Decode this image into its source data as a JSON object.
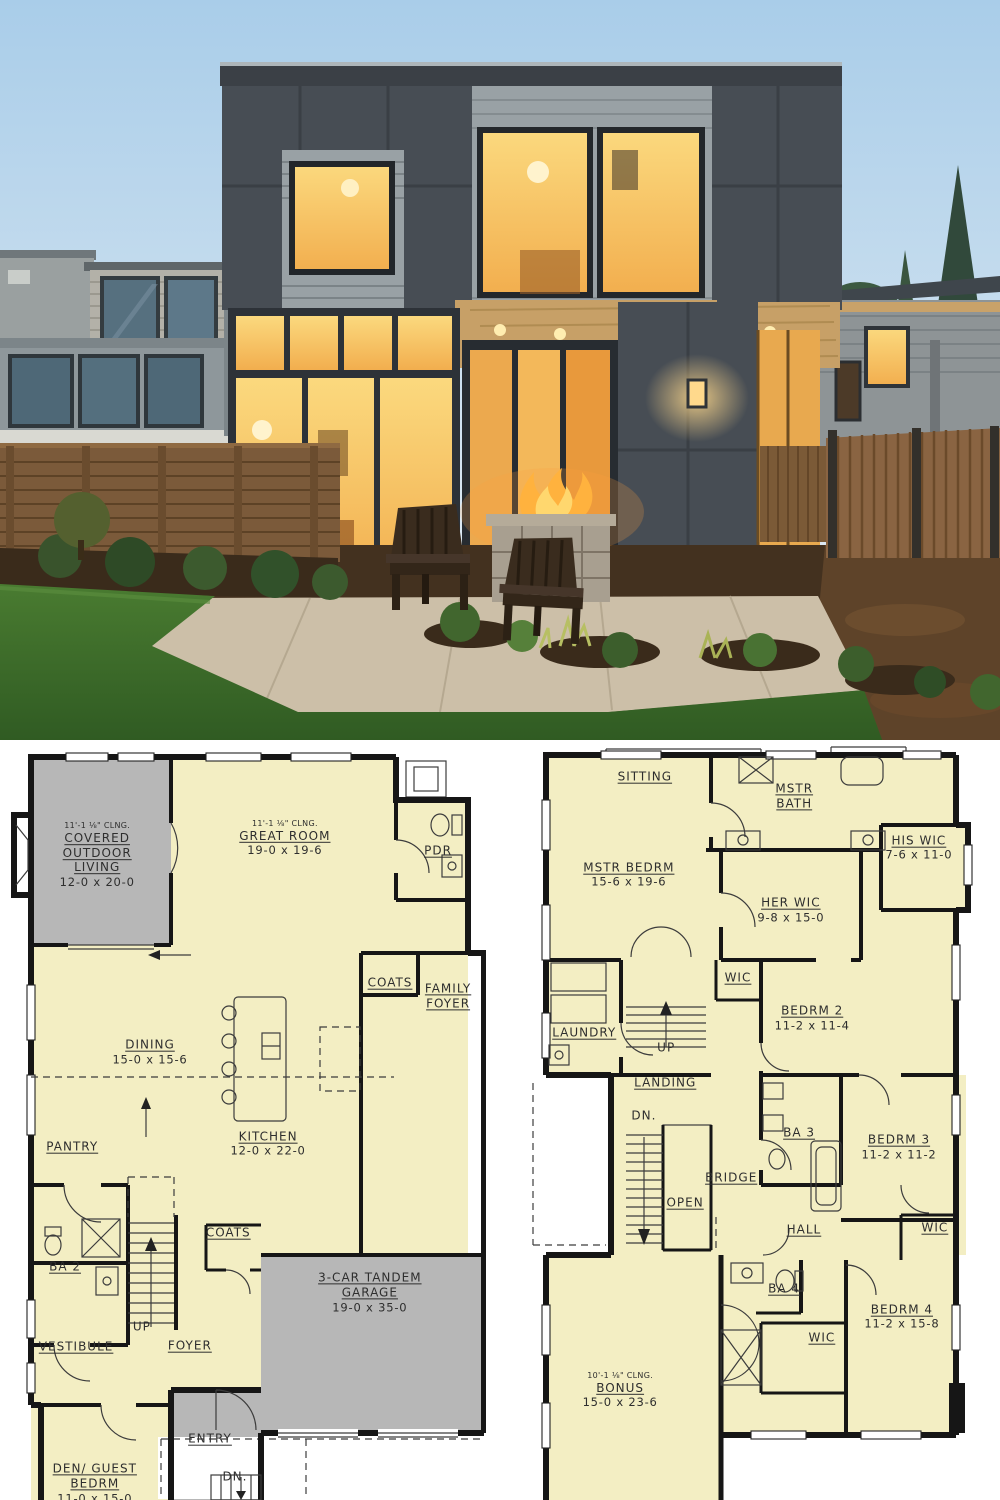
{
  "palette": {
    "sky_top": "#a9cde9",
    "sky_horizon": "#dde9f2",
    "siding_charcoal": "#474d54",
    "siding_gray": "#99a1a5",
    "window_glow": "#f2ae4e",
    "window_glow_light": "#fbd97e",
    "porch_wood": "#c7a067",
    "lawn": "#4a7c31",
    "lawn_dark": "#2f5a22",
    "fence_left": "#7b5a3a",
    "fence_right": "#8a6442",
    "mulch": "#5e4329",
    "patio": "#ccbfa8",
    "flame": "#ffb23e",
    "plan_room": "#f3eec3",
    "plan_gray": "#b7b7b7",
    "plan_wall": "#161616",
    "plan_line": "#3c3c3c",
    "plan_text": "#2e2e2e"
  },
  "floorplans": {
    "left": {
      "id": "main-floor",
      "rooms": [
        {
          "id": "covered-outdoor-living",
          "note": "11'-1 ⅛\" CLNG.",
          "name": "COVERED\nOUTDOOR\nLIVING",
          "dims": "12-0 x 20-0",
          "cx": 19.0,
          "cy": 14.6
        },
        {
          "id": "great-room",
          "note": "11'-1 ⅛\" CLNG.",
          "name": "GREAT ROOM",
          "dims": "19-0 x 19-6",
          "cx": 58.1,
          "cy": 12.3
        },
        {
          "id": "pdr",
          "name": "PDR",
          "cx": 90.0,
          "cy": 14.0
        },
        {
          "id": "coats-upper",
          "name": "COATS",
          "cx": 80.0,
          "cy": 31.5
        },
        {
          "id": "family-foyer",
          "name": "FAMILY\nFOYER",
          "cx": 92.1,
          "cy": 33.3
        },
        {
          "id": "dining",
          "name": "DINING",
          "dims": "15-0 x 15-6",
          "cx": 30.0,
          "cy": 40.7
        },
        {
          "id": "kitchen",
          "name": "KITCHEN",
          "dims": "12-0 x 22-0",
          "cx": 54.6,
          "cy": 52.8
        },
        {
          "id": "pantry",
          "name": "PANTRY",
          "cx": 13.8,
          "cy": 53.2
        },
        {
          "id": "ba-2",
          "name": "BA 2",
          "cx": 12.3,
          "cy": 69.1
        },
        {
          "id": "coats-lower",
          "name": "COATS",
          "cx": 46.3,
          "cy": 64.6
        },
        {
          "id": "up",
          "name": "UP",
          "u": false,
          "cx": 28.3,
          "cy": 77.1
        },
        {
          "id": "garage",
          "name": "3-CAR TANDEM\nGARAGE",
          "dims": "19-0 x 35-0",
          "cx": 75.8,
          "cy": 72.5
        },
        {
          "id": "vestibule",
          "name": "VESTIBULE",
          "cx": 14.6,
          "cy": 79.7
        },
        {
          "id": "foyer",
          "name": "FOYER",
          "cx": 38.3,
          "cy": 79.6
        },
        {
          "id": "entry",
          "name": "ENTRY",
          "cx": 42.5,
          "cy": 91.9
        },
        {
          "id": "dn",
          "name": "DN.",
          "u": false,
          "cx": 47.7,
          "cy": 97.0
        },
        {
          "id": "den-guest-bedrm",
          "name": "DEN/ GUEST\nBEDRM",
          "dims": "11-0 x 15-0",
          "cx": 18.5,
          "cy": 97.8
        }
      ]
    },
    "right": {
      "id": "upper-floor",
      "rooms": [
        {
          "id": "sitting",
          "name": "SITTING",
          "cx": 27.6,
          "cy": 4.2
        },
        {
          "id": "mstr-bath",
          "name": "MSTR\nBATH",
          "cx": 58.4,
          "cy": 6.8
        },
        {
          "id": "his-wic",
          "name": "HIS WIC",
          "dims": "7-6 x 11-0",
          "cx": 84.1,
          "cy": 13.6
        },
        {
          "id": "mstr-bedrm",
          "name": "MSTR BEDRM",
          "dims": "15-6 x 19-6",
          "cx": 24.3,
          "cy": 17.2
        },
        {
          "id": "her-wic",
          "name": "HER WIC",
          "dims": "9-8 x 15-0",
          "cx": 57.7,
          "cy": 21.9
        },
        {
          "id": "wic-bedrm2",
          "name": "WIC",
          "cx": 46.8,
          "cy": 30.8
        },
        {
          "id": "bedrm-2",
          "name": "BEDRM 2",
          "dims": "11-2 x 11-4",
          "cx": 62.1,
          "cy": 36.2
        },
        {
          "id": "laundry",
          "name": "LAUNDRY",
          "cx": 15.1,
          "cy": 38.2
        },
        {
          "id": "up",
          "name": "UP",
          "u": false,
          "cx": 32.0,
          "cy": 40.1
        },
        {
          "id": "landing",
          "name": "LANDING",
          "cx": 31.8,
          "cy": 44.8
        },
        {
          "id": "dn",
          "name": "DN.",
          "u": false,
          "cx": 27.4,
          "cy": 49.2
        },
        {
          "id": "open",
          "name": "OPEN",
          "cx": 35.9,
          "cy": 60.6
        },
        {
          "id": "bridge",
          "name": "BRIDGE",
          "cx": 45.4,
          "cy": 57.4
        },
        {
          "id": "ba-3",
          "name": "BA 3",
          "cx": 59.4,
          "cy": 51.4
        },
        {
          "id": "bedrm-3",
          "name": "BEDRM 3",
          "dims": "11-2 x 11-2",
          "cx": 80.0,
          "cy": 53.3
        },
        {
          "id": "hall",
          "name": "HALL",
          "cx": 60.4,
          "cy": 64.3
        },
        {
          "id": "wic-bedrm3",
          "name": "WIC",
          "cx": 87.4,
          "cy": 64.0
        },
        {
          "id": "ba-4",
          "name": "BA 4",
          "cx": 56.3,
          "cy": 72.0
        },
        {
          "id": "bedrm-4",
          "name": "BEDRM 4",
          "dims": "11-2 x 15-8",
          "cx": 80.6,
          "cy": 75.7
        },
        {
          "id": "wic-bedrm4",
          "name": "WIC",
          "cx": 64.1,
          "cy": 78.6
        },
        {
          "id": "bonus",
          "note": "10'-1 ⅛\" CLNG.",
          "name": "BONUS",
          "dims": "15-0 x 23-6",
          "cx": 22.5,
          "cy": 85.4
        }
      ]
    }
  }
}
